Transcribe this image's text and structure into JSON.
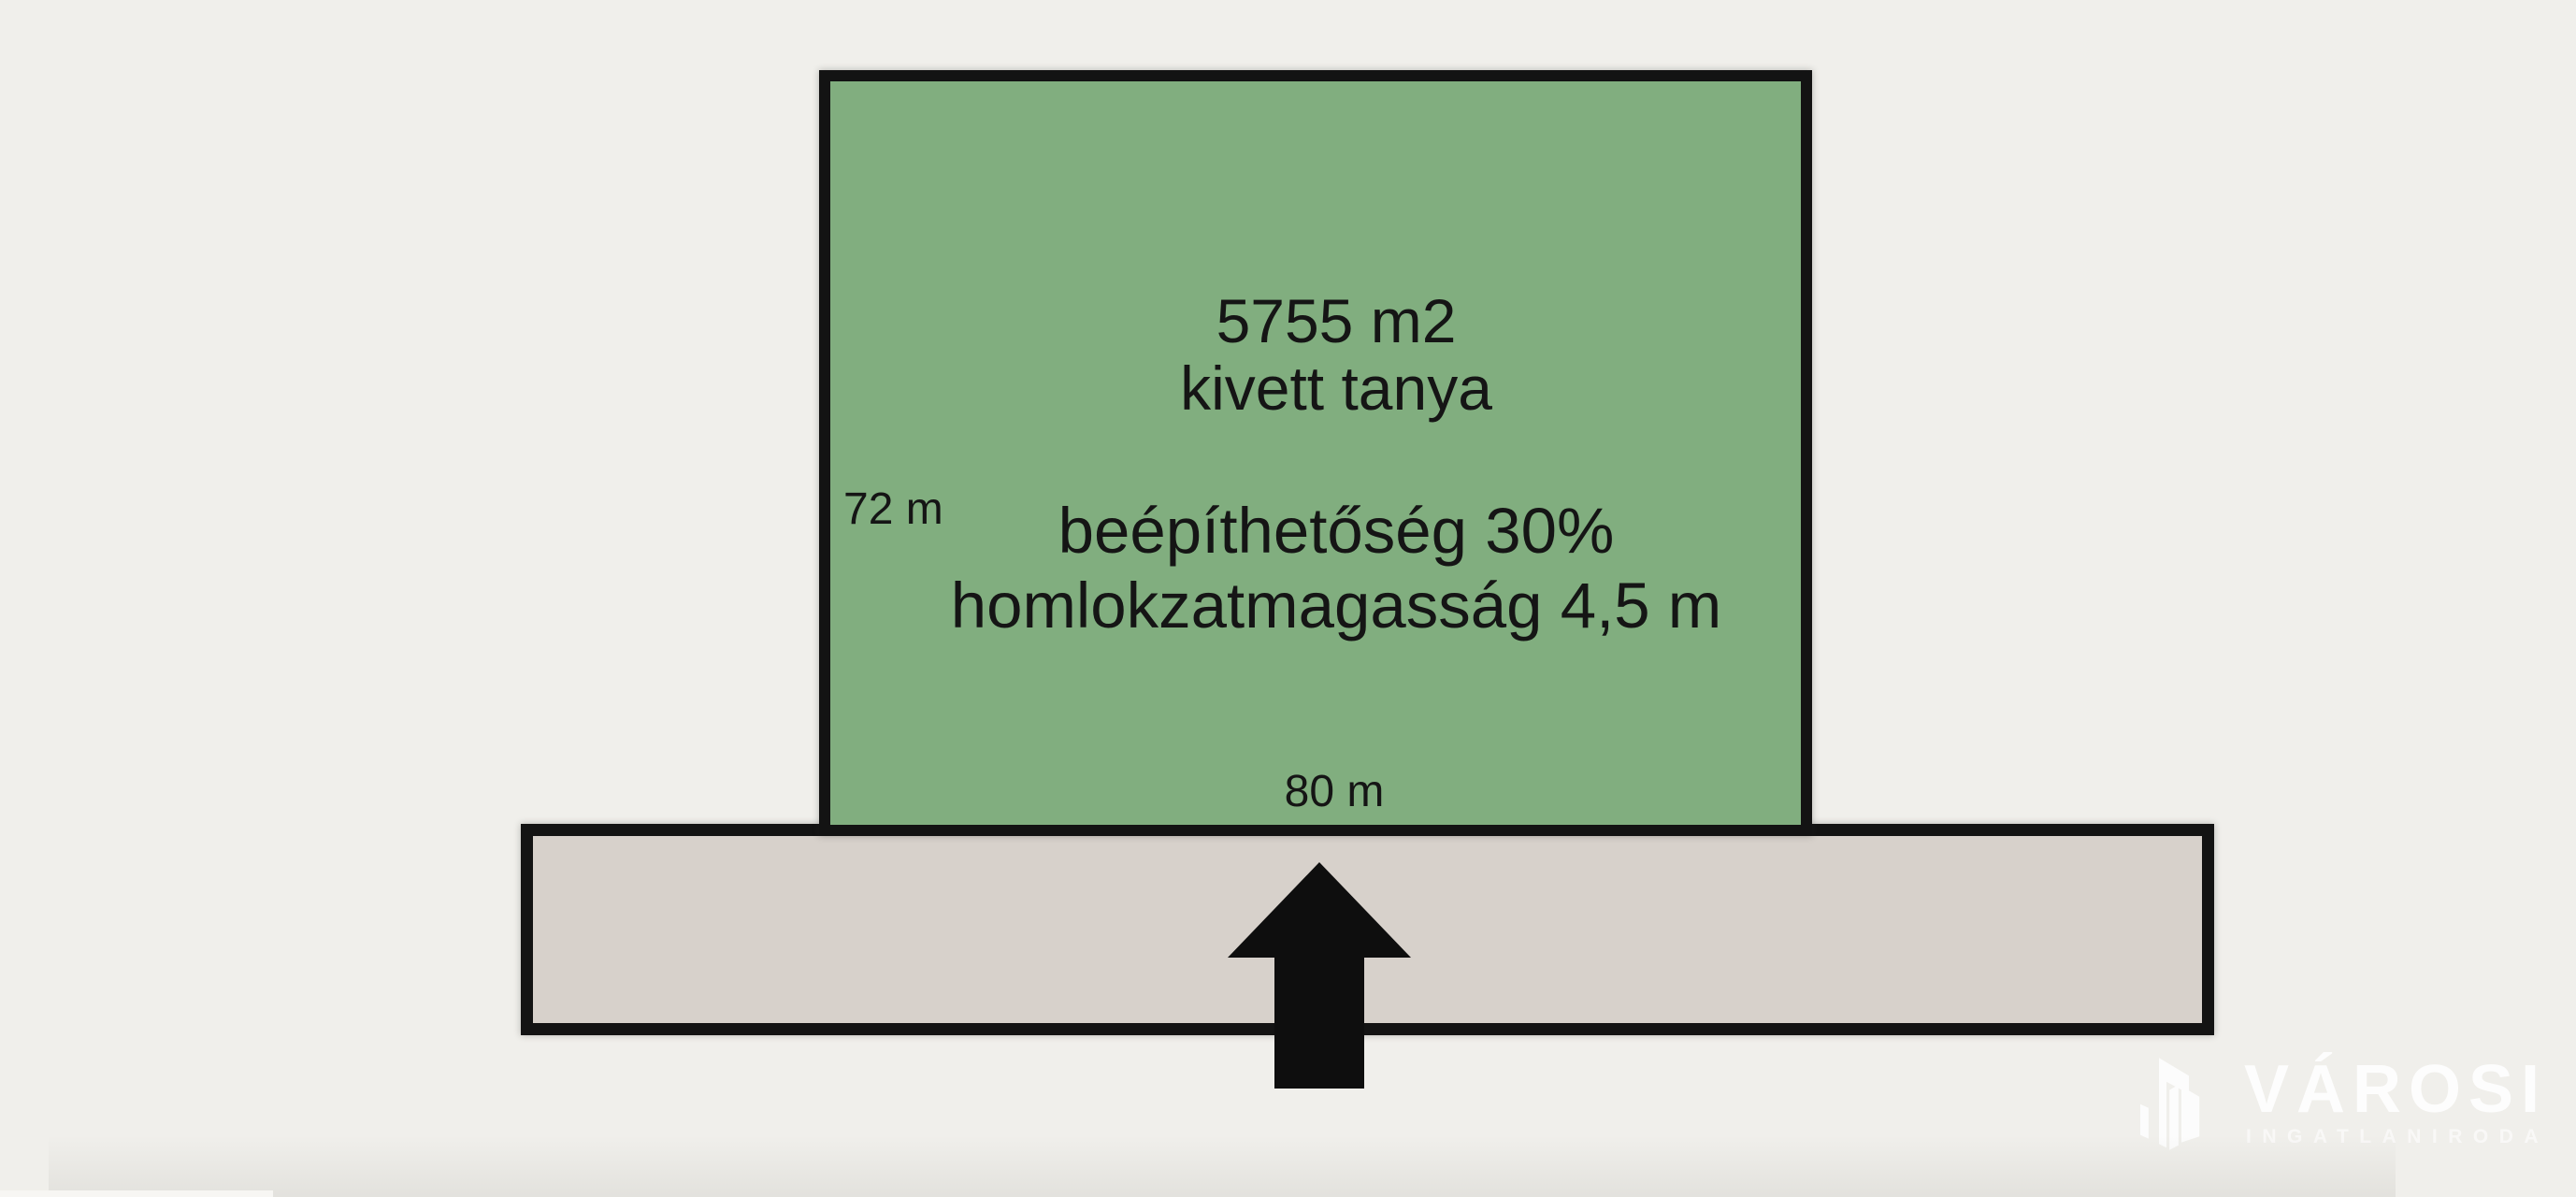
{
  "background_color": "#f0efeb",
  "plot": {
    "fill_color": "#81ae7f",
    "border_color": "#131313",
    "area": "5755 m2",
    "land_type": "kivett tanya",
    "buildability": "beépíthetőség 30%",
    "facade_height": "homlokzatmagasság 4,5 m",
    "side_length": "72 m",
    "front_length": "80 m"
  },
  "road": {
    "fill_color": "#d7d1cb",
    "border_color": "#131313"
  },
  "arrow": {
    "direction": "up",
    "color": "#0e0e0e"
  },
  "watermark": {
    "brand": "VÁROSI",
    "subtitle": "INGATLANIRODA",
    "text_color": "#ffffff"
  }
}
